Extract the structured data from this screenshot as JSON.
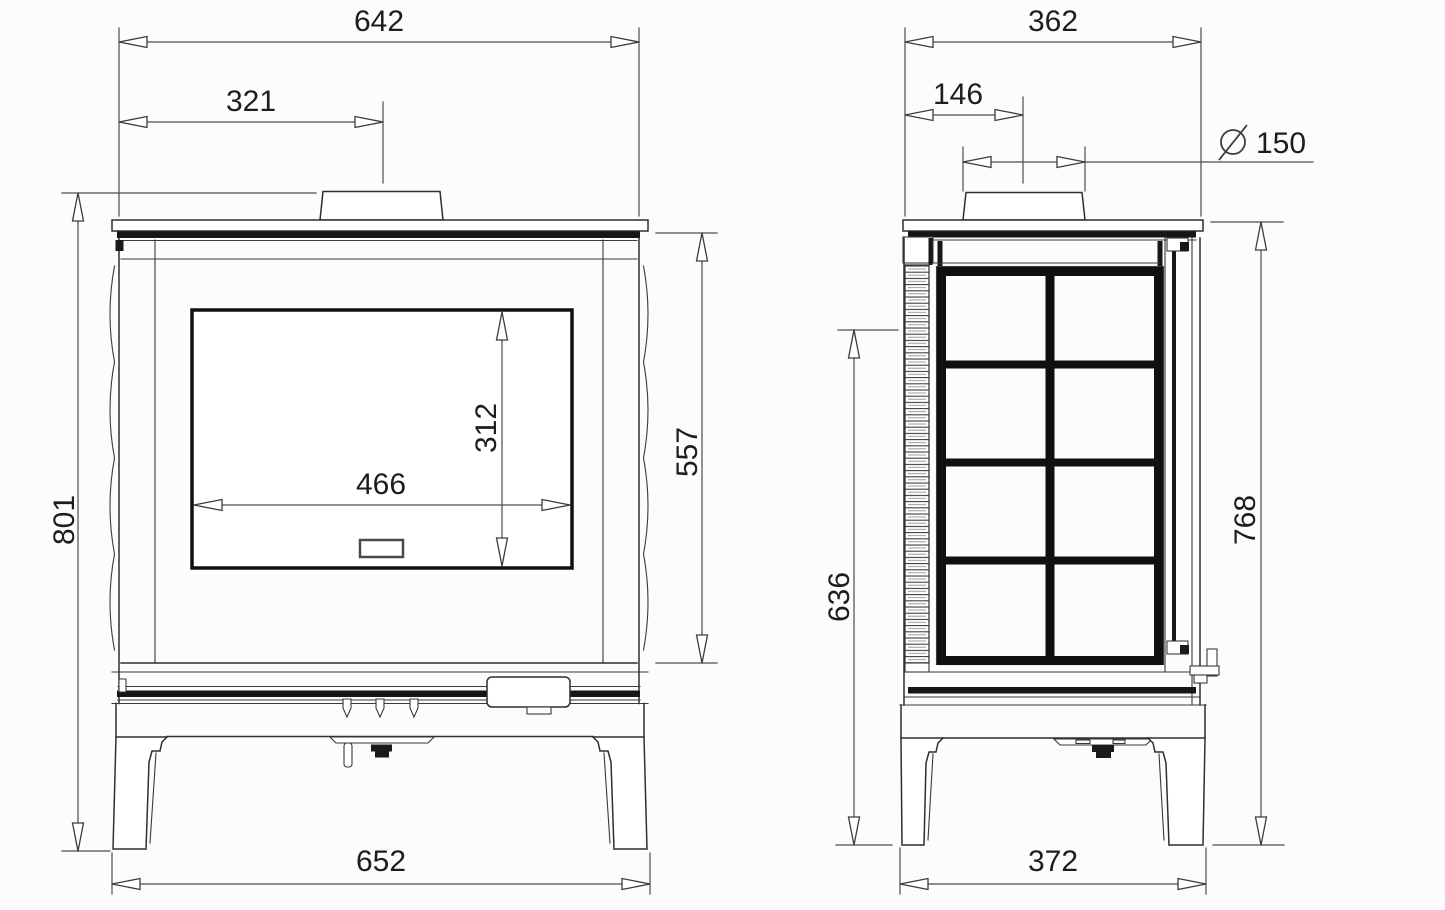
{
  "drawing": {
    "kind": "technical dimension drawing",
    "subject": "wood-burning stove — front and side elevation views",
    "background_color": "#fcfcfc",
    "line_color": "#2f2f2f",
    "dimension_line_color": "#4d4d4d",
    "text_color": "#1d1d1d"
  },
  "front_view": {
    "label": "front elevation",
    "dims": {
      "top_width": "642",
      "flue_offset": "321",
      "total_height": "801",
      "body_height": "557",
      "glass_width": "466",
      "glass_height": "312",
      "base_width": "652"
    }
  },
  "side_view": {
    "label": "side elevation",
    "dims": {
      "top_depth": "362",
      "flue_offset": "146",
      "flue_diameter_symbol": "⌀",
      "flue_diameter": "150",
      "panel_height": "636",
      "height_to_top": "768",
      "base_depth": "372"
    }
  }
}
